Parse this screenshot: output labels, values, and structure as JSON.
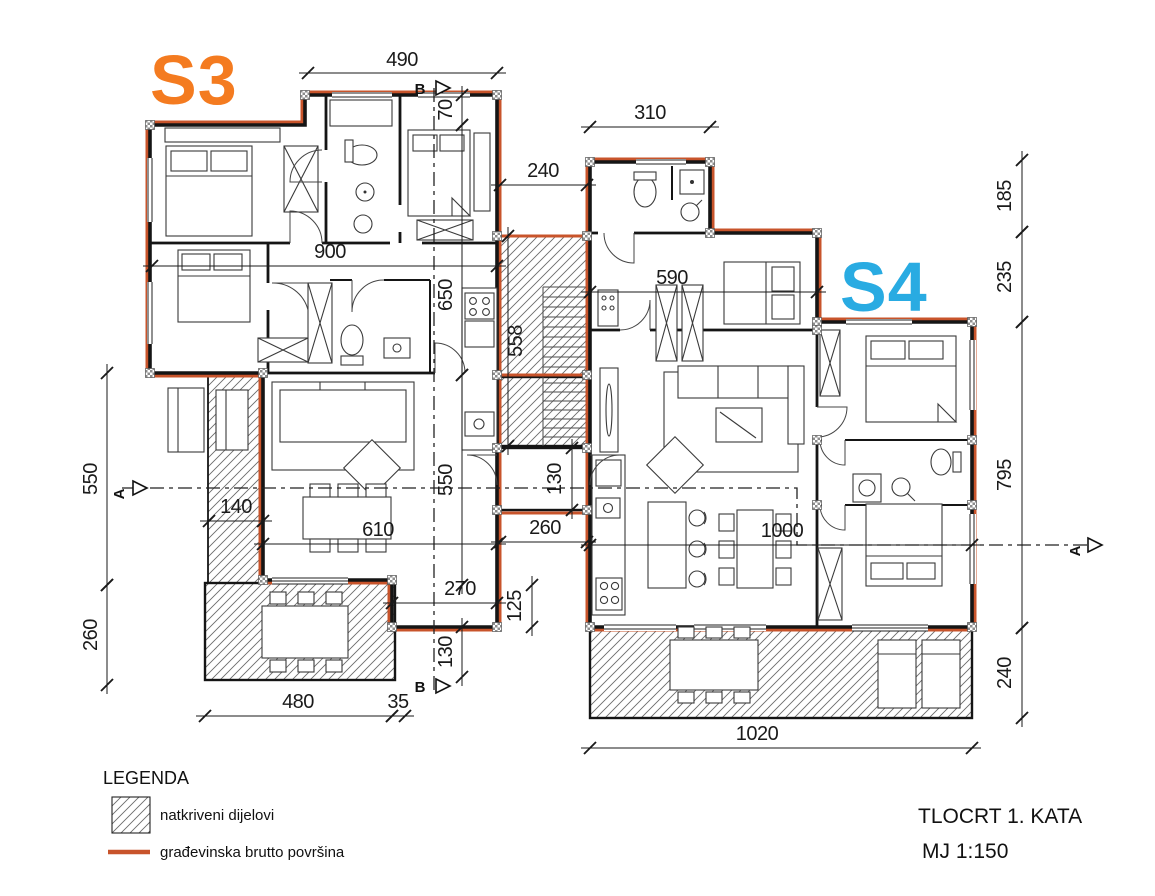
{
  "unit_labels": {
    "s3": "S3",
    "s4": "S4"
  },
  "title_block": {
    "title": "TLOCRT 1. KATA",
    "scale": "MJ 1:150"
  },
  "legend": {
    "heading": "LEGENDA",
    "hatch_label": "natkriveni dijelovi",
    "line_label": "građevinska brutto površina"
  },
  "section_markers": {
    "a": "A",
    "b": "B"
  },
  "colors": {
    "brutto": "#c8542b",
    "s3col": "#f47b20",
    "s4col": "#29abe2",
    "wall": "#151515",
    "dim": "#1a1a1a"
  },
  "dimensions": {
    "d490": "490",
    "d240_top": "240",
    "d310": "310",
    "d900": "900",
    "d590": "590",
    "d140": "140",
    "d610": "610",
    "d260_mid": "260",
    "d270": "270",
    "d1000": "1000",
    "d480": "480",
    "d35": "35",
    "d1020": "1020",
    "d70": "70",
    "d650": "650",
    "d550_mid": "550",
    "d130_bottom": "130",
    "d125": "125",
    "d558": "558",
    "d130_vest": "130",
    "d550_left": "550",
    "d260_left": "260",
    "d185": "185",
    "d235": "235",
    "d795": "795",
    "d240_right": "240"
  }
}
